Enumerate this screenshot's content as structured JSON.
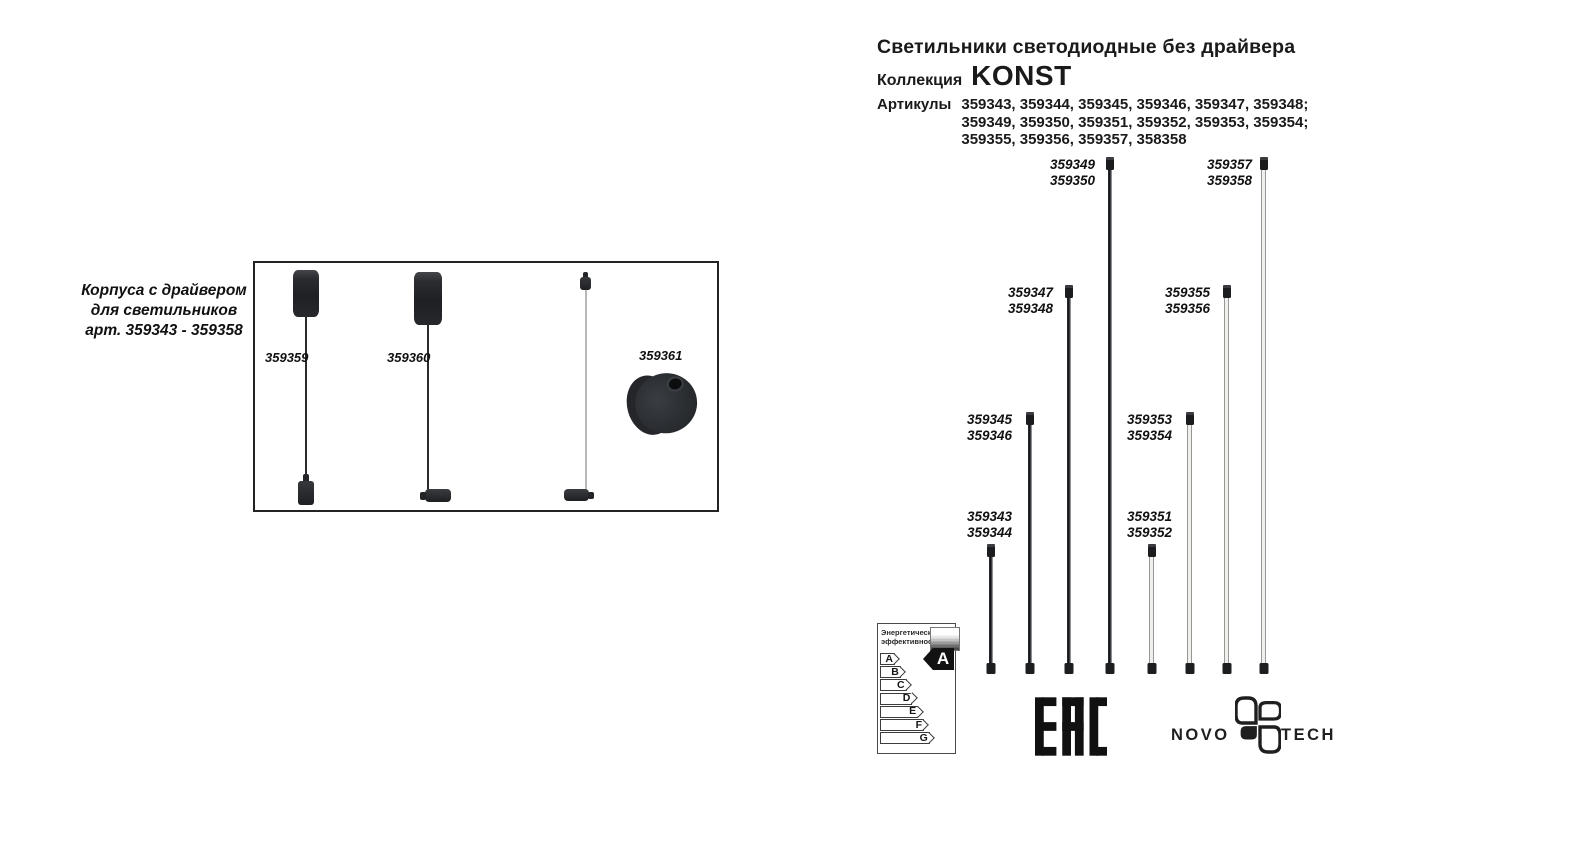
{
  "header": {
    "title": "Светильники светодиодные без драйвера",
    "collection_label": "Коллекция",
    "collection_name": "KONST",
    "articles_label": "Артикулы",
    "articles_lines": [
      "359343, 359344, 359345, 359346, 359347, 359348;",
      "359349, 359350, 359351, 359352, 359353, 359354;",
      "359355, 359356, 359357, 358358"
    ]
  },
  "housing_box": {
    "caption_lines": [
      "Корпуса с драйвером",
      "для светильников",
      "арт. 359343 - 359358"
    ],
    "items": [
      {
        "label": "359359"
      },
      {
        "label": "359360"
      },
      {
        "label": "359361"
      }
    ]
  },
  "rods": [
    {
      "lines": [
        "359343",
        "359344"
      ],
      "color": "black",
      "tier": 1
    },
    {
      "lines": [
        "359345",
        "359346"
      ],
      "color": "black",
      "tier": 2
    },
    {
      "lines": [
        "359347",
        "359348"
      ],
      "color": "black",
      "tier": 3
    },
    {
      "lines": [
        "359349",
        "359350"
      ],
      "color": "black",
      "tier": 4
    },
    {
      "lines": [
        "359351",
        "359352"
      ],
      "color": "white",
      "tier": 1
    },
    {
      "lines": [
        "359353",
        "359354"
      ],
      "color": "white",
      "tier": 2
    },
    {
      "lines": [
        "359355",
        "359356"
      ],
      "color": "white",
      "tier": 3
    },
    {
      "lines": [
        "359357",
        "359358"
      ],
      "color": "white",
      "tier": 4
    }
  ],
  "energy_label": {
    "header_lines": [
      "Энергетическая",
      "эффективность"
    ],
    "classes": [
      "A",
      "B",
      "C",
      "D",
      "E",
      "F",
      "G"
    ],
    "rating": "A"
  },
  "logos": {
    "eac": "EAC",
    "brand_left": "NOVO",
    "brand_right": "TECH"
  },
  "colors": {
    "ink": "#1a1a1a",
    "rod_black": "#1d1d1f",
    "rod_white": "#efefec"
  }
}
